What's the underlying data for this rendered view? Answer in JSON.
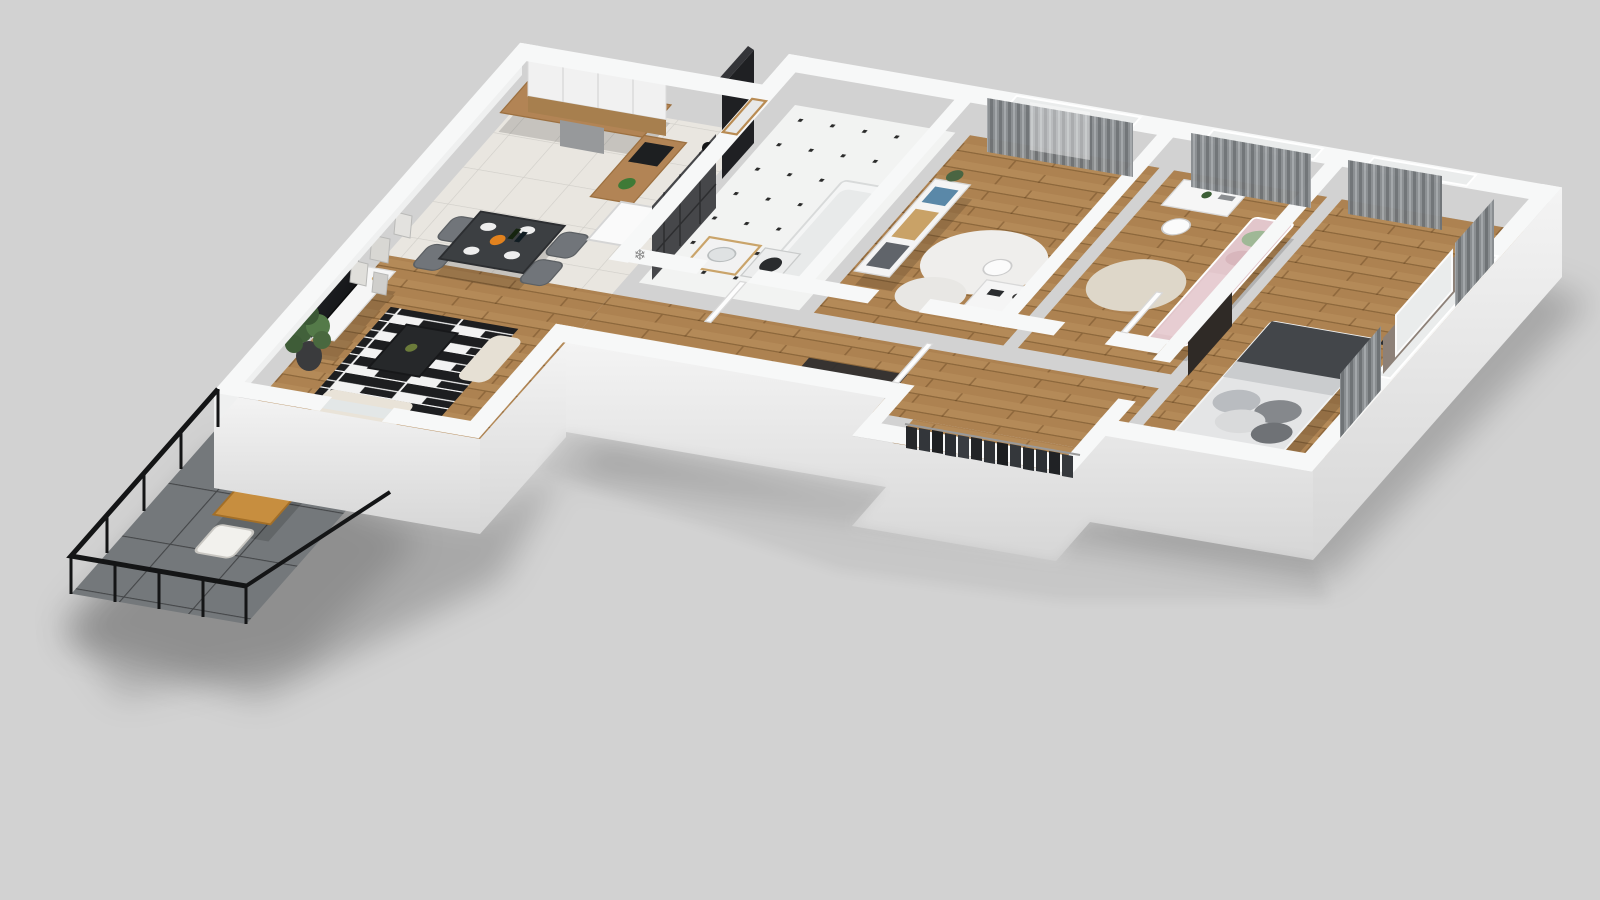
{
  "meta": {
    "type": "3d-floorplan-render",
    "view": "isometric-cutaway",
    "background_color": "#d2d2d2"
  },
  "icons": {
    "fridge_snowflake": "❄"
  },
  "palette": {
    "bg": "#d2d2d2",
    "wallTop": "#f7f8f8",
    "wallFace": "#e9eaea",
    "wallFaceDark": "#d7d8d8",
    "wood": "#b48a58",
    "woodDark": "#9c7646",
    "tile": "#e9e6e0",
    "bathFloor": "#f2f3f2",
    "darkTile": "#46474a",
    "curtain": "#8a8e91",
    "glass": "#eaecec",
    "counterWood": "#b28455",
    "cabinet": "#f1f1f1",
    "appliance": "#232528",
    "rugBlack": "#1d1e20",
    "rugWhite": "#f2f2f2",
    "balcTile": "#74787b",
    "balcWood": "#c78e3f",
    "cushion": "#f2f1ed",
    "bedWhite": "#e4e5e6",
    "bedDark": "#43464a",
    "kidBed": "#e2c6cb",
    "plant": "#4a6542",
    "shadow": "rgba(0,0,0,.20)"
  },
  "rooms": [
    {
      "name": "bathroom",
      "floor": "white-dot-tile",
      "features": [
        "dark-tile-shower",
        "bathtub",
        "vanity-sink",
        "washing-machine",
        "window"
      ]
    },
    {
      "name": "bedroom-1",
      "floor": "wood",
      "features": [
        "dresser",
        "round-rug",
        "desk",
        "two-windows",
        "gray-curtains",
        "wall-art"
      ]
    },
    {
      "name": "kids-room",
      "floor": "wood",
      "features": [
        "desk",
        "chair",
        "single-bed-pink",
        "windows",
        "gray-curtains"
      ]
    },
    {
      "name": "master-bedroom",
      "floor": "wood",
      "features": [
        "double-bed",
        "nightstand-plant",
        "dark-wall-panel",
        "corner-windows",
        "gray-curtains"
      ]
    },
    {
      "name": "hallway",
      "floor": "wood",
      "features": [
        "wardrobe-clothes-rail",
        "entry-mat",
        "doors"
      ]
    },
    {
      "name": "kitchen",
      "floor": "light-tile",
      "features": [
        "white-cabinets",
        "wood-counter",
        "sink",
        "cooktop",
        "oven",
        "coffee-machine",
        "fridge"
      ]
    },
    {
      "name": "dining",
      "floor": "light-tile",
      "features": [
        "dark-table",
        "four-gray-chairs",
        "tableware"
      ]
    },
    {
      "name": "living-room",
      "floor": "wood",
      "features": [
        "tv",
        "tv-stand",
        "wall-art",
        "potted-plant",
        "striped-rug",
        "coffee-table",
        "sofa"
      ]
    },
    {
      "name": "balcony",
      "floor": "dark-tile",
      "features": [
        "black-railing",
        "wood-table",
        "two-chairs-white-cushions"
      ]
    }
  ]
}
